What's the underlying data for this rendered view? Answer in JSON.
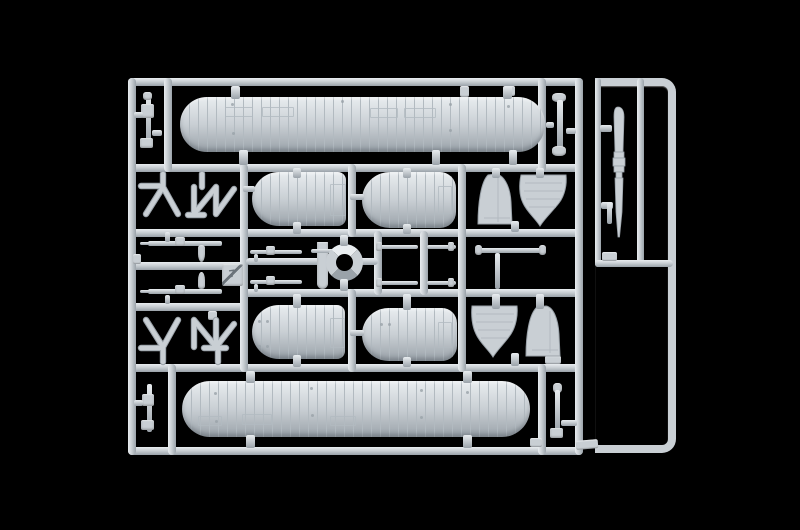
{
  "scene": {
    "type": "photograph",
    "subject": "Light-gray injection-molded plastic model kit sprue with biplane floatplane parts on a black background",
    "background_color": "#000000"
  },
  "colors": {
    "background": "#000000",
    "plastic_base": "#c9cfd4",
    "plastic_highlight": "#e9edf0",
    "plastic_shadow": "#9aa2a9",
    "rib_line": "#b2bac0",
    "marking": "#6b737a"
  },
  "sprue": {
    "runner_plate_number": "7",
    "parts_inventory": [
      {
        "name": "upper-wing",
        "label": "Upper biplane wing",
        "count": 1
      },
      {
        "name": "lower-wing",
        "label": "Lower biplane wing",
        "count": 1
      },
      {
        "name": "float-half",
        "label": "Float / fuselage half",
        "count": 4
      },
      {
        "name": "tail-fin",
        "label": "Tail fin",
        "count": 2
      },
      {
        "name": "rudder",
        "label": "Rudder / stabilizer half",
        "count": 2
      },
      {
        "name": "cabane-strut-assembly",
        "label": "Cabane strut assembly",
        "count": 4
      },
      {
        "name": "interplane-strut",
        "label": "Interplane strut",
        "count": 4
      },
      {
        "name": "cowl-ring",
        "label": "Engine cowling ring",
        "count": 1
      },
      {
        "name": "machine-gun",
        "label": "Machine gun",
        "count": 4
      },
      {
        "name": "bomb",
        "label": "Small bomb",
        "count": 1
      },
      {
        "name": "strut-rod",
        "label": "Rigging / strut rod",
        "count": 5
      },
      {
        "name": "propeller-blade",
        "label": "Propeller blade",
        "count": 1
      }
    ]
  },
  "labels": {
    "photo": "Model kit sprue photograph",
    "main_runner": "Main sprue runner frame",
    "side_runner": "Side sprue runner",
    "upper_wing": "Upper biplane wing",
    "lower_wing": "Lower biplane wing",
    "float_half": "Float / fuselage half",
    "fin": "Tail fin",
    "rudder": "Rudder / stabilizer half",
    "cowl_ring": "Engine cowling ring",
    "propeller": "Propeller blade",
    "struts": "Cabane strut assembly",
    "machine_gun": "Machine gun",
    "bomb": "Small bomb",
    "strut_rod": "Rigging / strut rod",
    "interplane_strut": "Interplane strut",
    "runner_plate": "Runner number plate"
  }
}
